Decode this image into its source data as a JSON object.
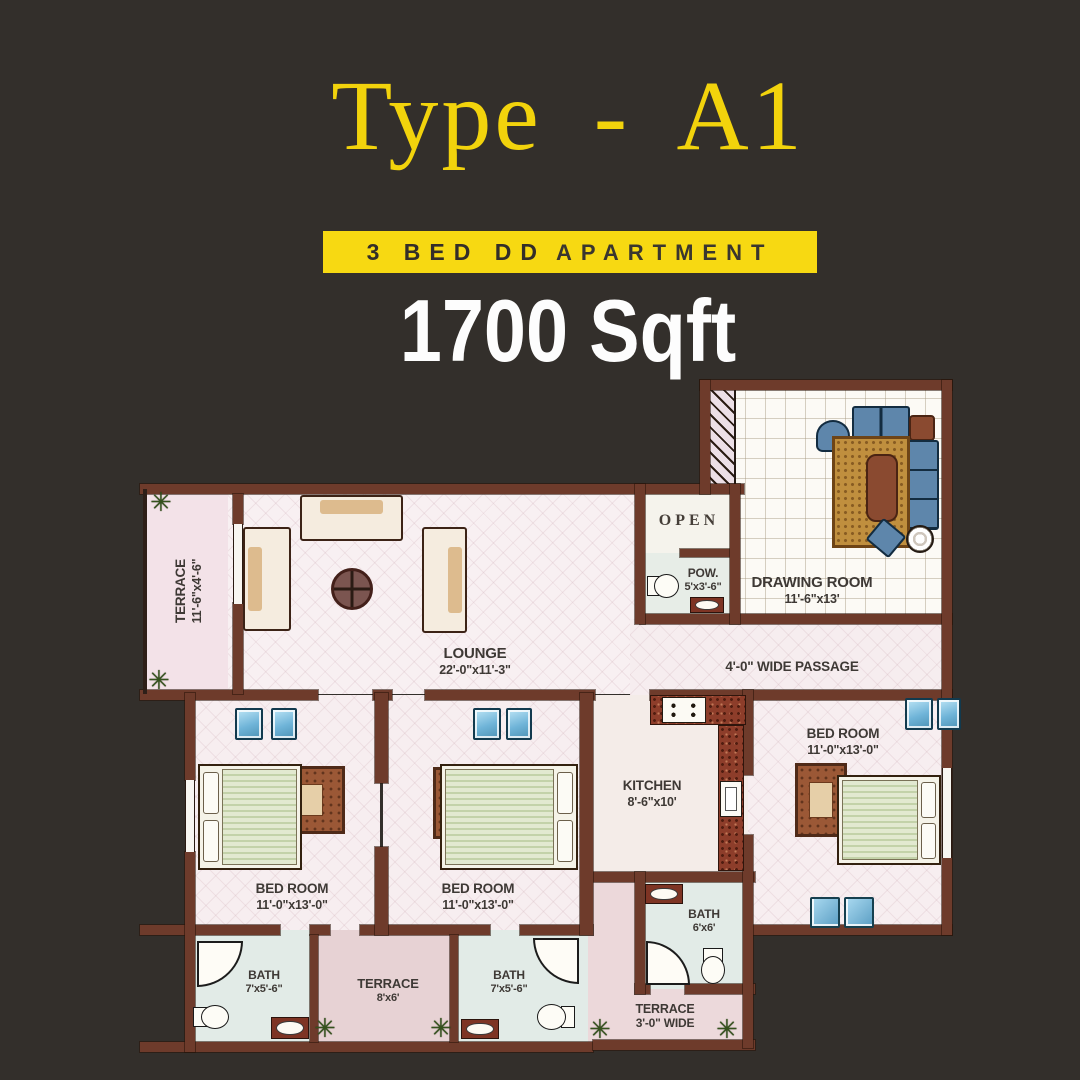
{
  "page": {
    "background": "#332f2b"
  },
  "header": {
    "title": "Type - A1",
    "banner_bold": "3 BED DD",
    "banner_rest": "APARTMENT",
    "area_label": "1700 Sqft",
    "colors": {
      "accent_yellow": "#f7d912",
      "title_yellow": "#f2d30c",
      "banner_text": "#332e29",
      "area_text": "#ffffff"
    }
  },
  "floorplan": {
    "colors": {
      "wall": "#6e3b2b",
      "floor": "#f7eef0",
      "window_blue": "#6fb4d8",
      "counter_red": "#8d3d2a"
    },
    "icons": {
      "plant": "✳"
    },
    "rooms": {
      "terrace_left": {
        "name": "TERRACE",
        "dims": "11'-6\"x4'-6\""
      },
      "lounge": {
        "name": "LOUNGE",
        "dims": "22'-0\"x11'-3\""
      },
      "open": {
        "name": "OPEN"
      },
      "pow": {
        "name": "POW.",
        "dims": "5'x3'-6\""
      },
      "drawing_room": {
        "name": "DRAWING ROOM",
        "dims": "11'-6\"x13'"
      },
      "passage": {
        "name": "4'-0\" WIDE PASSAGE"
      },
      "bed1": {
        "name": "BED ROOM",
        "dims": "11'-0\"x13'-0\""
      },
      "bed2": {
        "name": "BED ROOM",
        "dims": "11'-0\"x13'-0\""
      },
      "bed3": {
        "name": "BED ROOM",
        "dims": "11'-0\"x13'-0\""
      },
      "kitchen": {
        "name": "KITCHEN",
        "dims": "8'-6\"x10'"
      },
      "bath1": {
        "name": "BATH",
        "dims": "7'x5'-6\""
      },
      "bath2": {
        "name": "BATH",
        "dims": "7'x5'-6\""
      },
      "bath3": {
        "name": "BATH",
        "dims": "6'x6'"
      },
      "terrace_mid": {
        "name": "TERRACE",
        "dims": "8'x6'"
      },
      "terrace_right": {
        "name": "TERRACE",
        "dims": "3'-0\" WIDE"
      }
    }
  }
}
